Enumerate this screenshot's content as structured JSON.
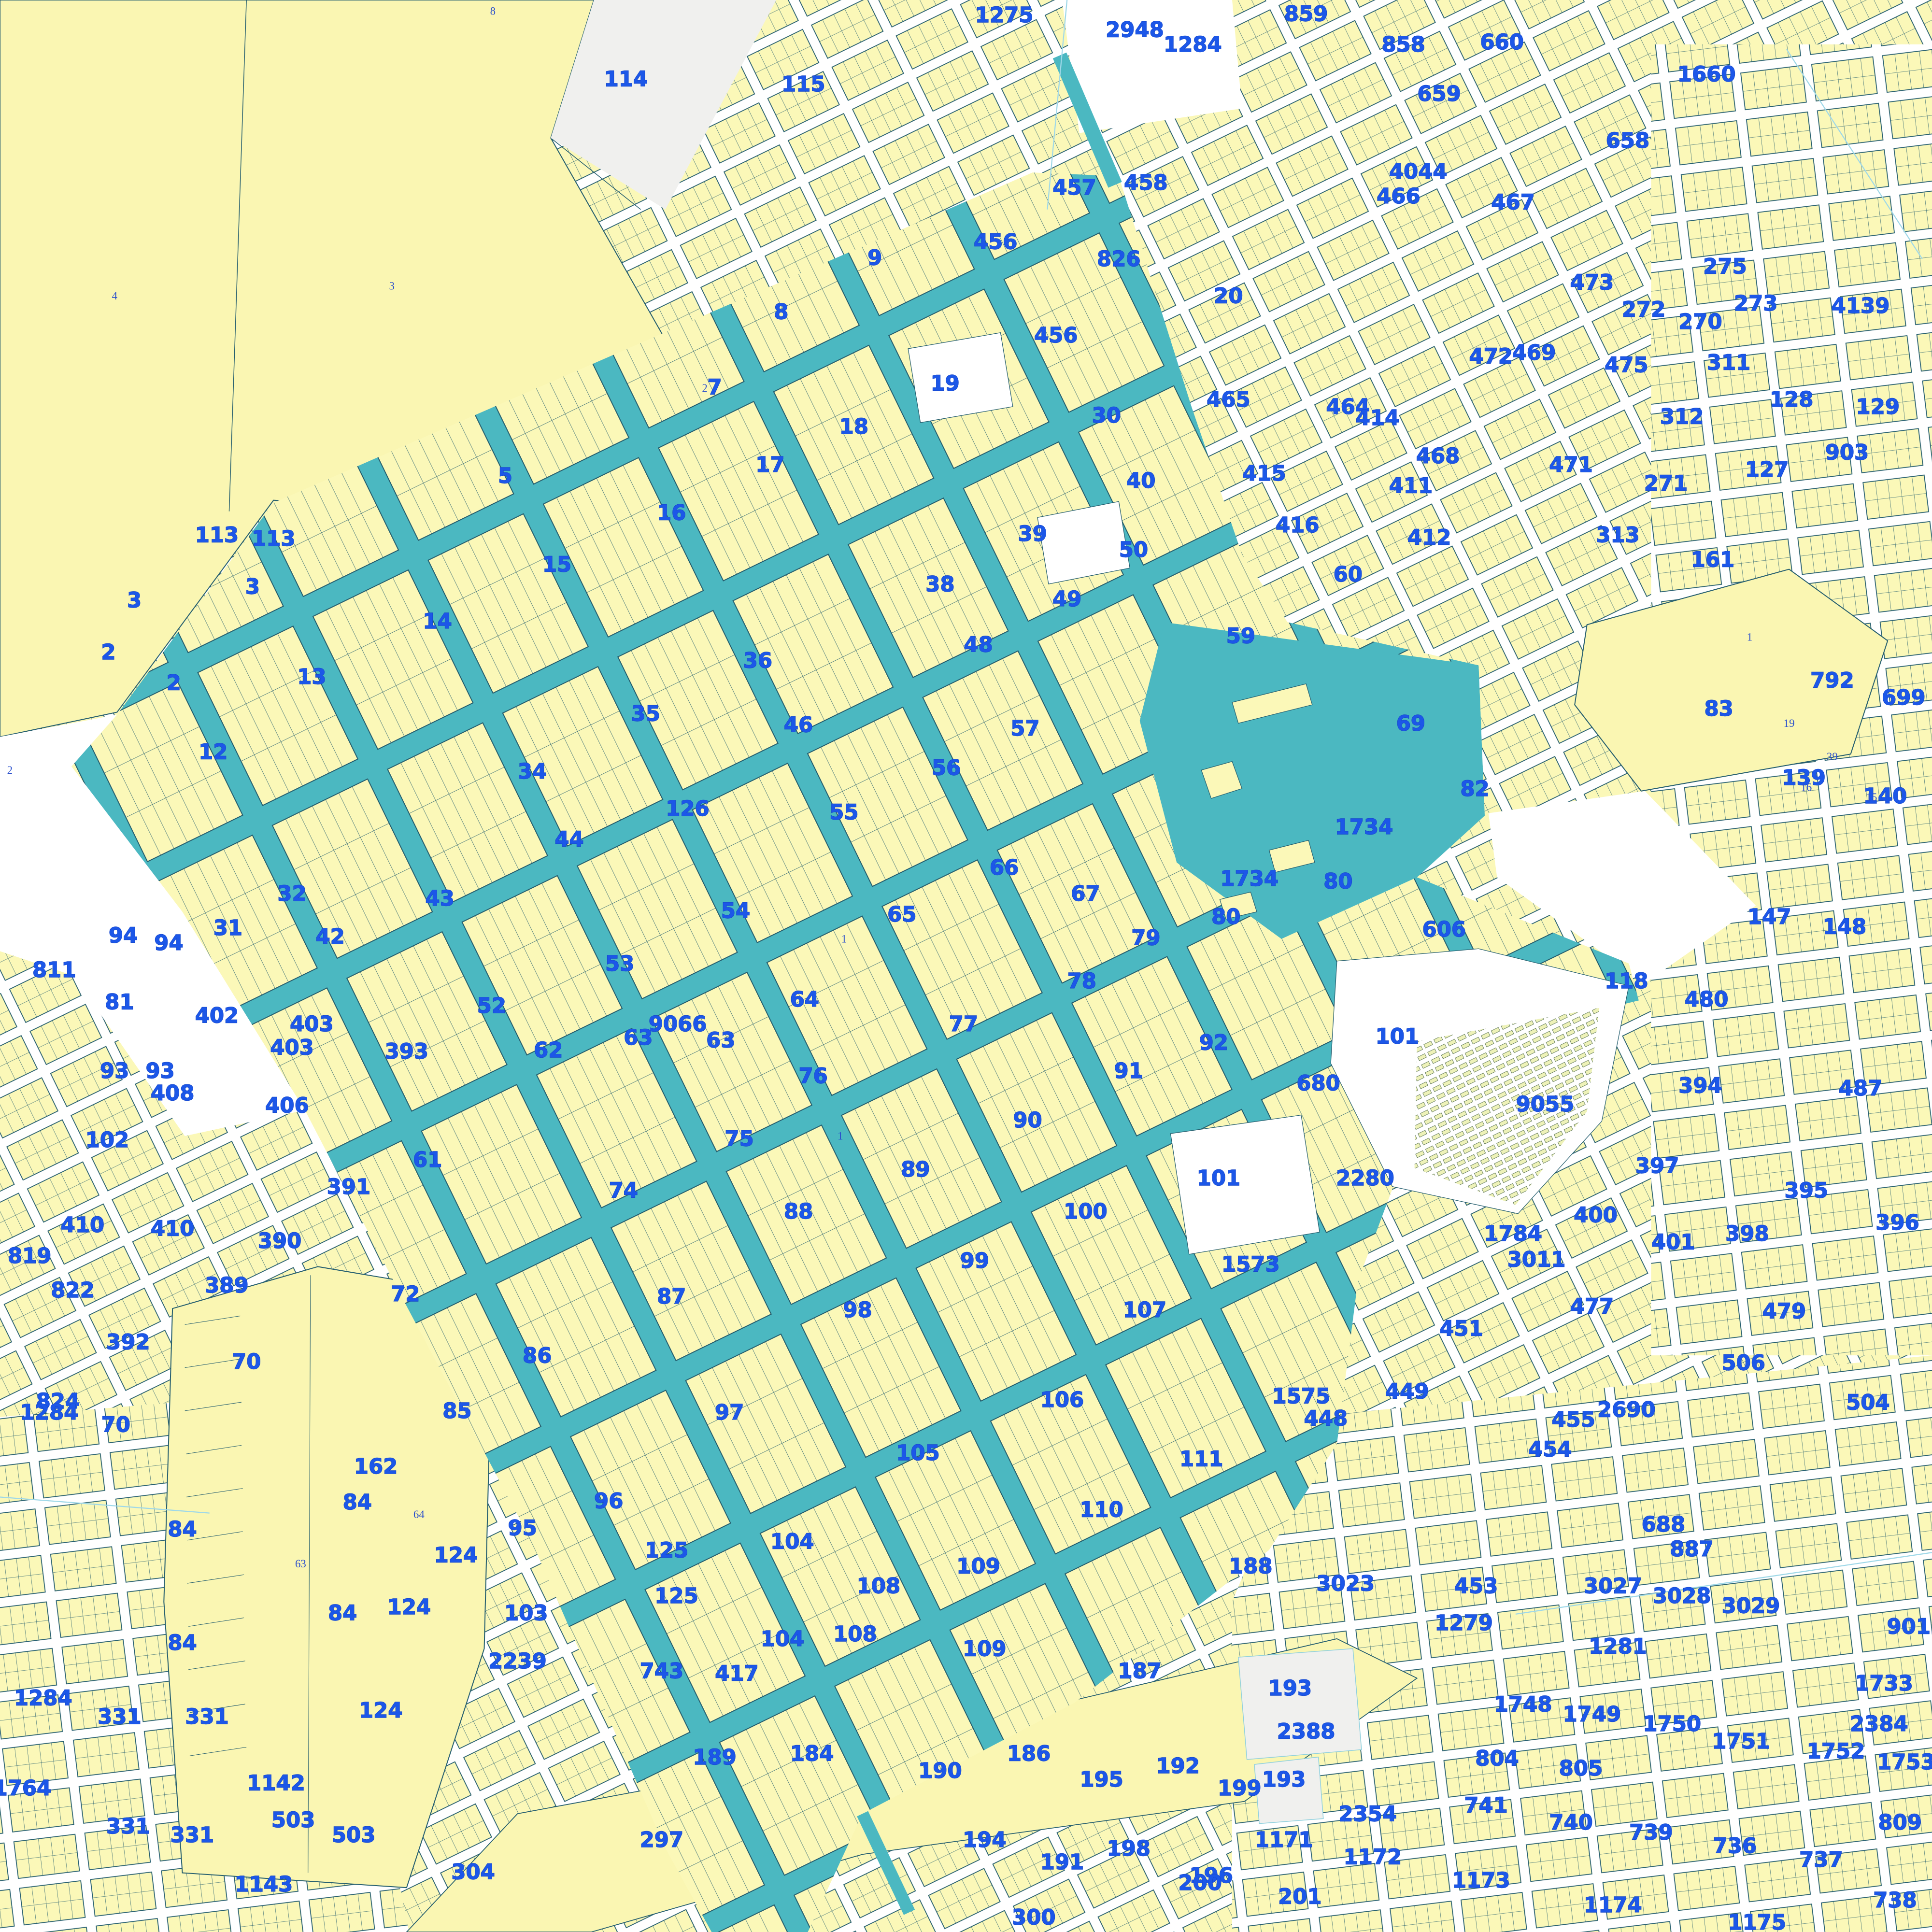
{
  "map": {
    "title": "cadastral-parcel-map",
    "colors": {
      "parcel_yellow": "#FBF8B8",
      "field_yellow": "#FAF6B2",
      "street_teal": "#4BB8C1",
      "outline_dark": "#265f6f",
      "label_blue": "#1c57e8",
      "minor_blue": "#2b50cc",
      "grey_area": "#f0f0ee",
      "cyan_line": "#9fd8e8",
      "white": "#ffffff"
    },
    "labels": [
      [
        508,
        70,
        "114"
      ],
      [
        652,
        74,
        "115"
      ],
      [
        710,
        215,
        "9"
      ],
      [
        634,
        259,
        "8"
      ],
      [
        580,
        320,
        "7"
      ],
      [
        815,
        18,
        "1275"
      ],
      [
        921,
        30,
        "2948"
      ],
      [
        968,
        42,
        "1284"
      ],
      [
        1060,
        17,
        "859"
      ],
      [
        1139,
        42,
        "858"
      ],
      [
        1219,
        40,
        "660"
      ],
      [
        1168,
        82,
        "659"
      ],
      [
        1385,
        66,
        "1660"
      ],
      [
        1321,
        120,
        "658"
      ],
      [
        1135,
        165,
        "466"
      ],
      [
        1228,
        170,
        "467"
      ],
      [
        1151,
        145,
        "4044"
      ],
      [
        908,
        216,
        "826"
      ],
      [
        808,
        202,
        "456"
      ],
      [
        857,
        278,
        "456"
      ],
      [
        872,
        158,
        "457"
      ],
      [
        930,
        154,
        "458"
      ],
      [
        997,
        246,
        "20"
      ],
      [
        1334,
        257,
        "272"
      ],
      [
        1400,
        222,
        "275"
      ],
      [
        1245,
        292,
        "469"
      ],
      [
        1167,
        376,
        "468"
      ],
      [
        1275,
        383,
        "471"
      ],
      [
        1352,
        398,
        "271"
      ],
      [
        1499,
        373,
        "903"
      ],
      [
        1292,
        235,
        "473"
      ],
      [
        1320,
        302,
        "475"
      ],
      [
        1380,
        267,
        "270"
      ],
      [
        1425,
        252,
        "273"
      ],
      [
        1510,
        254,
        "4139"
      ],
      [
        1403,
        300,
        "311"
      ],
      [
        1454,
        330,
        "128"
      ],
      [
        1524,
        336,
        "129"
      ],
      [
        1434,
        387,
        "127"
      ],
      [
        1365,
        344,
        "312"
      ],
      [
        1313,
        440,
        "313"
      ],
      [
        1390,
        460,
        "161"
      ],
      [
        1210,
        295,
        "472"
      ],
      [
        1094,
        336,
        "464"
      ],
      [
        997,
        330,
        "465"
      ],
      [
        1026,
        390,
        "415"
      ],
      [
        1118,
        345,
        "414"
      ],
      [
        1145,
        400,
        "411"
      ],
      [
        1160,
        442,
        "412"
      ],
      [
        1053,
        432,
        "416"
      ],
      [
        1094,
        472,
        "60"
      ],
      [
        1145,
        593,
        "69"
      ],
      [
        1007,
        522,
        "59"
      ],
      [
        222,
        443,
        "113"
      ],
      [
        176,
        440,
        "113"
      ],
      [
        109,
        493,
        "3"
      ],
      [
        205,
        482,
        "3"
      ],
      [
        88,
        535,
        "2"
      ],
      [
        141,
        560,
        "2"
      ],
      [
        253,
        555,
        "13"
      ],
      [
        173,
        616,
        "12"
      ],
      [
        237,
        731,
        "32"
      ],
      [
        185,
        759,
        "31"
      ],
      [
        268,
        766,
        "42"
      ],
      [
        357,
        735,
        "43"
      ],
      [
        410,
        392,
        "5"
      ],
      [
        355,
        510,
        "14"
      ],
      [
        452,
        464,
        "15"
      ],
      [
        545,
        422,
        "16"
      ],
      [
        625,
        383,
        "17"
      ],
      [
        693,
        352,
        "18"
      ],
      [
        767,
        317,
        "19"
      ],
      [
        898,
        343,
        "30"
      ],
      [
        926,
        396,
        "40"
      ],
      [
        838,
        439,
        "39"
      ],
      [
        615,
        542,
        "36"
      ],
      [
        763,
        480,
        "38"
      ],
      [
        920,
        452,
        "50"
      ],
      [
        866,
        492,
        "49"
      ],
      [
        794,
        529,
        "48"
      ],
      [
        648,
        594,
        "46"
      ],
      [
        524,
        585,
        "35"
      ],
      [
        558,
        662,
        "126"
      ],
      [
        432,
        632,
        "34"
      ],
      [
        462,
        687,
        "44"
      ],
      [
        832,
        597,
        "57"
      ],
      [
        768,
        629,
        "56"
      ],
      [
        685,
        665,
        "55"
      ],
      [
        597,
        745,
        "54"
      ],
      [
        503,
        788,
        "53"
      ],
      [
        399,
        822,
        "52"
      ],
      [
        653,
        817,
        "64"
      ],
      [
        518,
        848,
        "63"
      ],
      [
        585,
        850,
        "63"
      ],
      [
        550,
        837,
        "9066"
      ],
      [
        445,
        858,
        "62"
      ],
      [
        347,
        947,
        "61"
      ],
      [
        97,
        819,
        "81"
      ],
      [
        732,
        748,
        "65"
      ],
      [
        815,
        710,
        "66"
      ],
      [
        881,
        731,
        "67"
      ],
      [
        782,
        837,
        "77"
      ],
      [
        600,
        930,
        "75"
      ],
      [
        660,
        879,
        "76"
      ],
      [
        506,
        972,
        "74"
      ],
      [
        329,
        1056,
        "72"
      ],
      [
        878,
        802,
        "78"
      ],
      [
        930,
        767,
        "79"
      ],
      [
        1086,
        721,
        "80"
      ],
      [
        995,
        750,
        "80"
      ],
      [
        1107,
        677,
        "1734"
      ],
      [
        1014,
        719,
        "1734"
      ],
      [
        1172,
        760,
        "606"
      ],
      [
        1070,
        885,
        "680"
      ],
      [
        1197,
        646,
        "82"
      ],
      [
        1134,
        847,
        "101"
      ],
      [
        1108,
        962,
        "2280"
      ],
      [
        648,
        989,
        "88"
      ],
      [
        743,
        955,
        "89"
      ],
      [
        834,
        915,
        "90"
      ],
      [
        916,
        875,
        "91"
      ],
      [
        985,
        852,
        "92"
      ],
      [
        881,
        989,
        "100"
      ],
      [
        989,
        962,
        "101"
      ],
      [
        791,
        1029,
        "99"
      ],
      [
        696,
        1069,
        "98"
      ],
      [
        592,
        1152,
        "97"
      ],
      [
        494,
        1224,
        "96"
      ],
      [
        424,
        1246,
        "95"
      ],
      [
        436,
        1106,
        "86"
      ],
      [
        545,
        1058,
        "87"
      ],
      [
        371,
        1151,
        "85"
      ],
      [
        745,
        1185,
        "105"
      ],
      [
        862,
        1142,
        "106"
      ],
      [
        975,
        1190,
        "111"
      ],
      [
        894,
        1231,
        "110"
      ],
      [
        794,
        1277,
        "109"
      ],
      [
        799,
        1344,
        "109"
      ],
      [
        713,
        1293,
        "108"
      ],
      [
        694,
        1332,
        "108"
      ],
      [
        643,
        1257,
        "104"
      ],
      [
        635,
        1336,
        "104"
      ],
      [
        427,
        1315,
        "103"
      ],
      [
        541,
        1264,
        "125"
      ],
      [
        549,
        1301,
        "125"
      ],
      [
        370,
        1268,
        "124"
      ],
      [
        332,
        1310,
        "124"
      ],
      [
        1254,
        902,
        "9055"
      ],
      [
        1320,
        802,
        "118"
      ],
      [
        1385,
        817,
        "480"
      ],
      [
        1436,
        750,
        "147"
      ],
      [
        1497,
        758,
        "148"
      ],
      [
        1464,
        637,
        "139"
      ],
      [
        1530,
        652,
        "140"
      ],
      [
        1395,
        581,
        "83"
      ],
      [
        1487,
        558,
        "792"
      ],
      [
        1545,
        572,
        "699"
      ],
      [
        1380,
        887,
        "394"
      ],
      [
        1345,
        952,
        "397"
      ],
      [
        1295,
        992,
        "400"
      ],
      [
        1418,
        1007,
        "398"
      ],
      [
        1358,
        1014,
        "401"
      ],
      [
        1466,
        972,
        "395"
      ],
      [
        1540,
        998,
        "396"
      ],
      [
        1510,
        889,
        "487"
      ],
      [
        1228,
        1007,
        "1784"
      ],
      [
        1247,
        1028,
        "3011"
      ],
      [
        1186,
        1084,
        "451"
      ],
      [
        1142,
        1135,
        "449"
      ],
      [
        1076,
        1157,
        "448"
      ],
      [
        1056,
        1139,
        "1575"
      ],
      [
        1015,
        1032,
        "1573"
      ],
      [
        929,
        1069,
        "107"
      ],
      [
        1292,
        1066,
        "477"
      ],
      [
        1448,
        1070,
        "479"
      ],
      [
        1415,
        1112,
        "506"
      ],
      [
        1516,
        1144,
        "504"
      ],
      [
        1277,
        1158,
        "455"
      ],
      [
        1258,
        1182,
        "454"
      ],
      [
        1320,
        1150,
        "2690"
      ],
      [
        1350,
        1243,
        "688"
      ],
      [
        1373,
        1263,
        "887"
      ],
      [
        100,
        765,
        "94"
      ],
      [
        137,
        771,
        "94"
      ],
      [
        44,
        793,
        "811"
      ],
      [
        176,
        830,
        "402"
      ],
      [
        253,
        837,
        "403"
      ],
      [
        237,
        856,
        "403"
      ],
      [
        233,
        903,
        "406"
      ],
      [
        140,
        893,
        "408"
      ],
      [
        104,
        1095,
        "392"
      ],
      [
        24,
        1025,
        "819"
      ],
      [
        87,
        931,
        "102"
      ],
      [
        93,
        875,
        "93"
      ],
      [
        130,
        875,
        "93"
      ],
      [
        330,
        859,
        "393"
      ],
      [
        283,
        969,
        "391"
      ],
      [
        227,
        1013,
        "390"
      ],
      [
        184,
        1049,
        "389"
      ],
      [
        67,
        1000,
        "410"
      ],
      [
        140,
        1003,
        "410"
      ],
      [
        59,
        1053,
        "822"
      ],
      [
        47,
        1143,
        "824"
      ],
      [
        200,
        1111,
        "70"
      ],
      [
        94,
        1162,
        "70"
      ],
      [
        40,
        1152,
        "1284"
      ],
      [
        35,
        1384,
        "1284"
      ],
      [
        290,
        1225,
        "84"
      ],
      [
        278,
        1315,
        "84"
      ],
      [
        148,
        1247,
        "84"
      ],
      [
        148,
        1339,
        "84"
      ],
      [
        305,
        1196,
        "162"
      ],
      [
        18,
        1457,
        "1764"
      ],
      [
        97,
        1399,
        "331"
      ],
      [
        168,
        1399,
        "331"
      ],
      [
        104,
        1488,
        "331"
      ],
      [
        156,
        1495,
        "331"
      ],
      [
        224,
        1453,
        "1142"
      ],
      [
        238,
        1483,
        "503"
      ],
      [
        287,
        1495,
        "503"
      ],
      [
        214,
        1535,
        "1143"
      ],
      [
        309,
        1394,
        "124"
      ],
      [
        420,
        1354,
        "2239"
      ],
      [
        537,
        1362,
        "743"
      ],
      [
        598,
        1364,
        "417"
      ],
      [
        580,
        1432,
        "189"
      ],
      [
        659,
        1429,
        "184"
      ],
      [
        537,
        1499,
        "297"
      ],
      [
        384,
        1525,
        "304"
      ],
      [
        839,
        1562,
        "300"
      ],
      [
        763,
        1443,
        "190"
      ],
      [
        894,
        1450,
        "195"
      ],
      [
        799,
        1499,
        "194"
      ],
      [
        916,
        1506,
        "198"
      ],
      [
        835,
        1429,
        "186"
      ],
      [
        925,
        1362,
        "187"
      ],
      [
        1015,
        1277,
        "188"
      ],
      [
        1092,
        1291,
        "3023"
      ],
      [
        956,
        1439,
        "192"
      ],
      [
        862,
        1517,
        "191"
      ],
      [
        983,
        1528,
        "196"
      ],
      [
        1006,
        1457,
        "199"
      ],
      [
        1047,
        1376,
        "193"
      ],
      [
        1042,
        1450,
        "193"
      ],
      [
        1060,
        1411,
        "2388"
      ],
      [
        1110,
        1478,
        "2354"
      ],
      [
        1042,
        1499,
        "1171"
      ],
      [
        1114,
        1513,
        "1172"
      ],
      [
        974,
        1534,
        "200"
      ],
      [
        1055,
        1545,
        "201"
      ],
      [
        1202,
        1532,
        "1173"
      ],
      [
        1309,
        1552,
        "1174"
      ],
      [
        1426,
        1566,
        "1175"
      ],
      [
        1188,
        1323,
        "1279"
      ],
      [
        1313,
        1342,
        "1281"
      ],
      [
        1309,
        1293,
        "3027"
      ],
      [
        1365,
        1301,
        "3028"
      ],
      [
        1421,
        1309,
        "3029"
      ],
      [
        1555,
        1326,
        "9012"
      ],
      [
        1529,
        1372,
        "1733"
      ],
      [
        1525,
        1405,
        "2384"
      ],
      [
        1236,
        1389,
        "1748"
      ],
      [
        1292,
        1397,
        "1749"
      ],
      [
        1357,
        1405,
        "1750"
      ],
      [
        1413,
        1419,
        "1751"
      ],
      [
        1490,
        1427,
        "1752"
      ],
      [
        1547,
        1436,
        "1753"
      ],
      [
        1215,
        1433,
        "804"
      ],
      [
        1283,
        1441,
        "805"
      ],
      [
        1206,
        1471,
        "741"
      ],
      [
        1275,
        1485,
        "740"
      ],
      [
        1340,
        1493,
        "739"
      ],
      [
        1408,
        1504,
        "736"
      ],
      [
        1478,
        1515,
        "737"
      ],
      [
        1538,
        1548,
        "738"
      ],
      [
        1542,
        1485,
        "809"
      ],
      [
        1198,
        1293,
        "453"
      ]
    ],
    "minor_labels": [
      [
        93,
        243,
        "4"
      ],
      [
        318,
        235,
        "3"
      ],
      [
        400,
        12,
        "8"
      ],
      [
        572,
        318,
        "2"
      ],
      [
        244,
        1272,
        "63"
      ],
      [
        340,
        1232,
        "64"
      ],
      [
        1420,
        520,
        "1"
      ],
      [
        1452,
        590,
        "19"
      ],
      [
        1487,
        617,
        "39"
      ],
      [
        1466,
        642,
        "16"
      ],
      [
        1519,
        650,
        "15"
      ],
      [
        685,
        765,
        "1"
      ],
      [
        8,
        628,
        "2"
      ],
      [
        682,
        925,
        "1"
      ]
    ]
  }
}
